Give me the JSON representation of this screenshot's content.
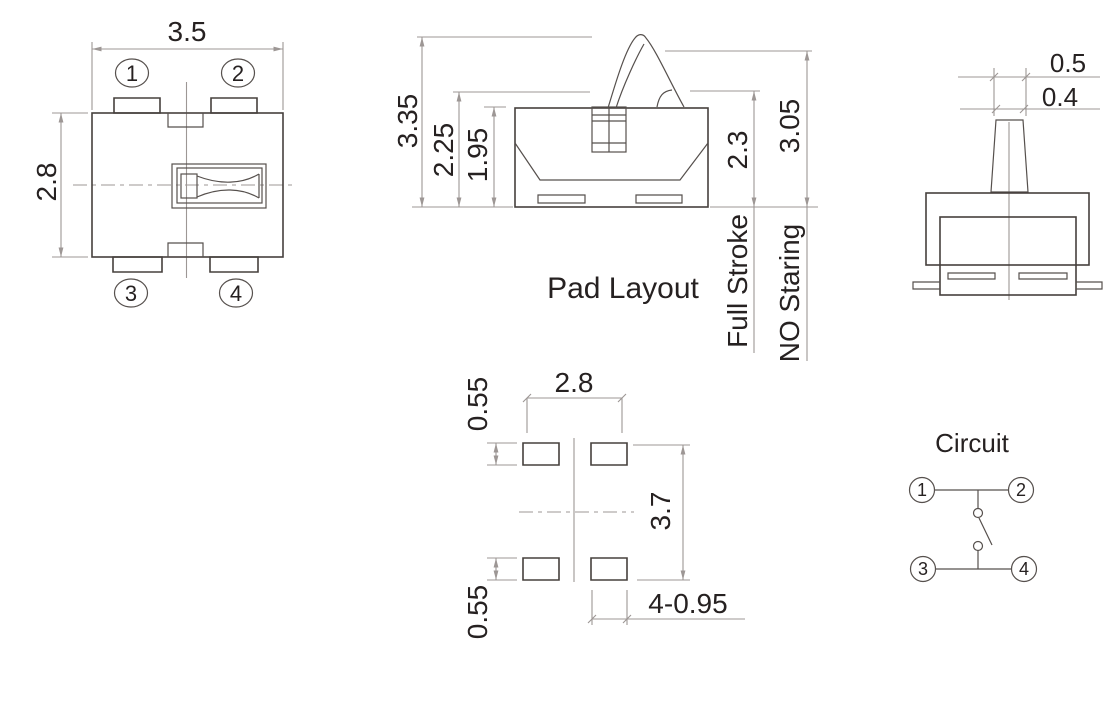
{
  "colors": {
    "outline": "#46403d",
    "dimension_line": "#9d9795",
    "text": "#262121",
    "background": "#ffffff"
  },
  "top_view": {
    "width_dim": "3.5",
    "height_dim": "2.8",
    "pins": [
      "1",
      "2",
      "3",
      "4"
    ]
  },
  "front_view": {
    "dims_left": [
      "3.35",
      "2.25",
      "1.95"
    ],
    "dims_right": [
      "2.3",
      "3.05"
    ],
    "full_stroke_label": "Full Stroke",
    "no_staring_label": "NO Staring"
  },
  "side_view": {
    "dims": [
      "0.5",
      "0.4"
    ]
  },
  "pad_layout": {
    "title": "Pad Layout",
    "pitch_x": "2.8",
    "pitch_y": "3.7",
    "pad_height_top": "0.55",
    "pad_height_bottom": "0.55",
    "pad_spec": "4-0.95"
  },
  "circuit": {
    "title": "Circuit",
    "pins": [
      "1",
      "2",
      "3",
      "4"
    ]
  }
}
